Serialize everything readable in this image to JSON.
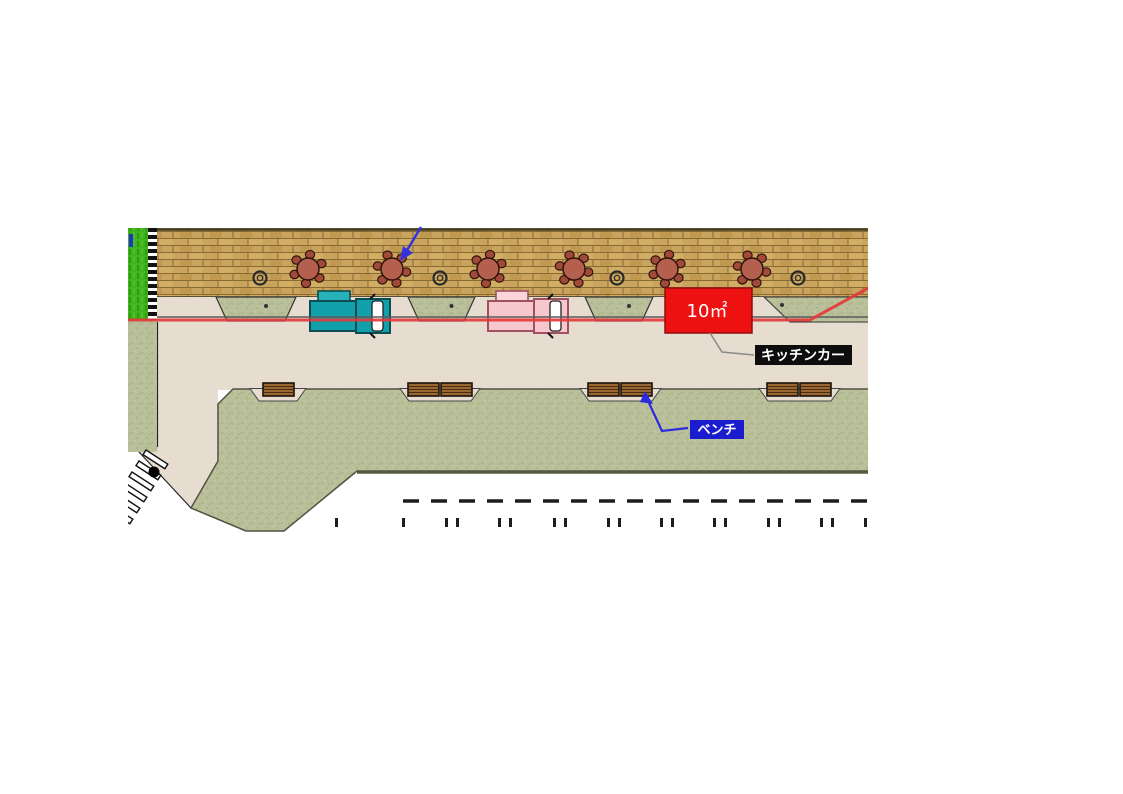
{
  "drawing": {
    "labels": {
      "area_label": "10㎡",
      "kitchen_car_label": "キッチンカー",
      "bench_label": "ベンチ"
    },
    "colors": {
      "red_box": "#ee1111",
      "red_box_border": "#8f0e0e",
      "kitchen_car_bg": "#0d0d0d",
      "bench_bg": "#1c1ccF",
      "label_text": "#ffffff",
      "red_line": "#e4393c",
      "gray_line": "#5a5a5a",
      "deck_wood": "#c9a45e",
      "deck_line": "#8a6a33",
      "lawn_green": "#3fb31c",
      "verge_green": "#b9bf98",
      "path_beige": "#e6dccf",
      "table_red": "#b5604f",
      "chair_red": "#a24a3a",
      "bench_wood": "#9a6632",
      "arrow_blue": "#3333dd",
      "outline_dark": "#222222"
    },
    "stall": {
      "x": 665,
      "y": 288,
      "w": 87,
      "h": 45
    },
    "tables": {
      "y": 269,
      "r": 11,
      "xs": [
        308,
        392,
        488,
        574,
        667,
        752
      ]
    },
    "planter_rings": {
      "y": 278,
      "xs": [
        260,
        440,
        617,
        798
      ]
    },
    "planters": [
      [
        216,
        296
      ],
      [
        408,
        475
      ],
      [
        585,
        653
      ]
    ],
    "bench_notches": [
      [
        250,
        306
      ],
      [
        400,
        480
      ],
      [
        580,
        661
      ],
      [
        759,
        840
      ]
    ],
    "benches": {
      "y": 383,
      "w": 31,
      "h": 13,
      "xs": [
        263,
        408,
        441,
        588,
        621,
        767,
        800
      ]
    },
    "trucks": [
      {
        "x": 310,
        "palette": "teal"
      },
      {
        "x": 488,
        "palette": "pink"
      }
    ],
    "road": {
      "dash_y": 501,
      "tick_pairs": [
        445,
        498,
        553,
        607,
        660,
        713,
        767,
        820
      ],
      "tick_singles": [
        335,
        402,
        864
      ]
    }
  }
}
